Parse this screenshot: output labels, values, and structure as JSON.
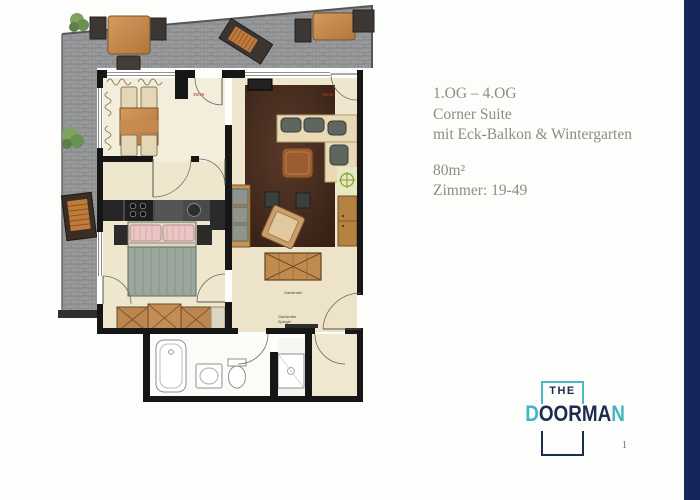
{
  "page": {
    "background": "#fdfdfb",
    "page_number": "1"
  },
  "accent_bar": {
    "color": "#15265b"
  },
  "info_panel": {
    "floor_range": "1.OG – 4.OG",
    "suite_name": "Corner Suite",
    "suite_features": "mit Eck-Balkon & Wintergarten",
    "area": "80m²",
    "rooms": "Zimmer: 19-49",
    "text_color": "#8d8c88"
  },
  "logo": {
    "word_the": "THE",
    "doorman_d": "D",
    "doorman_oorma": "OORMA",
    "doorman_n": "N",
    "navy": "#1e2c4d",
    "teal": "#41b7c5"
  },
  "floor_plan": {
    "room_number_label_left": "39/49",
    "room_number_label_right": "39/49",
    "hall_label_sideboard": "Garderobe",
    "hall_label_mirror_line1": "Garderobe",
    "hall_label_mirror_line2": "Spiegel",
    "colors": {
      "terrace_tile": "#98999a",
      "interior_floor": "#eee6cd",
      "wintergarten_floor": "#f3eddb",
      "living_room_floor": "#43291d",
      "wall": "#161616",
      "wood_furniture": "#c0874d",
      "bed_blanket": "#9ba69d",
      "pillow": "#e9c5c3"
    }
  }
}
